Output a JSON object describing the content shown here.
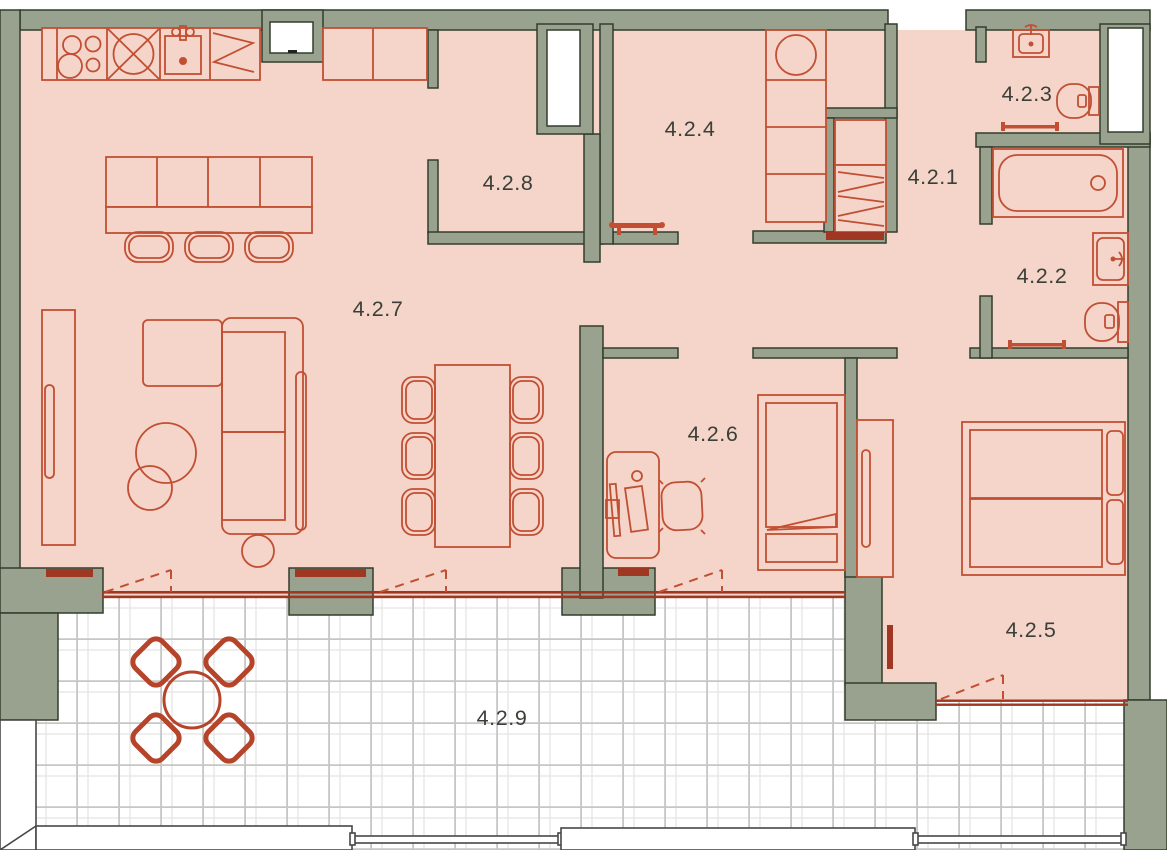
{
  "plan_type": "apartment-floor-plan-with-terrace",
  "rooms": [
    {
      "label": "4.2.7"
    },
    {
      "label": "4.2.8"
    },
    {
      "label": "4.2.4"
    },
    {
      "label": "4.2.1"
    },
    {
      "label": "4.2.3"
    },
    {
      "label": "4.2.2"
    },
    {
      "label": "4.2.6"
    },
    {
      "label": "4.2.5"
    },
    {
      "label": "4.2.9"
    }
  ],
  "colors": {
    "wall_fill": "#99a18f",
    "wall_outline": "#333d2c",
    "floor_fill": "#f5d4c9",
    "furniture_line": "#c14f33",
    "threshold_dark_red": "#a03722",
    "terrace_furniture": "#b5442a",
    "tile_grid": "#c6c6c6",
    "tile_grid_light": "#e4e4e4",
    "label_text": "#3a3f37",
    "railing_outline": "#474747",
    "background": "#ffffff"
  }
}
